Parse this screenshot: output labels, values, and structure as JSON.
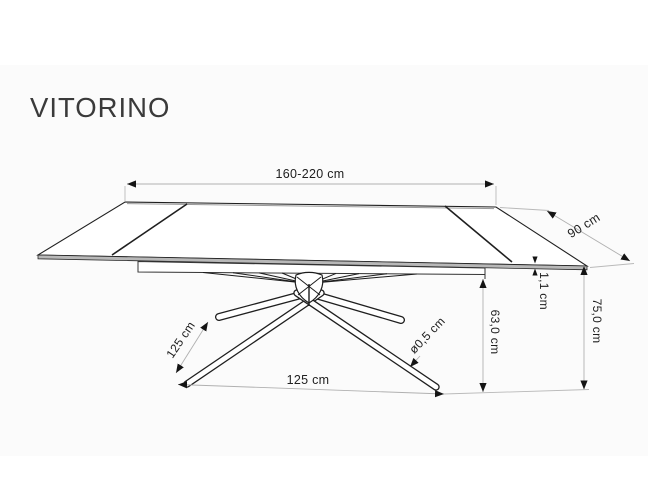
{
  "title": "VITORINO",
  "diagram": {
    "subject": "extendable-dining-table-dimension-drawing",
    "colors": {
      "line": "#1f1f1f",
      "dimension_line": "#b0b0b0",
      "text": "#202020",
      "title": "#3a3a3a",
      "edge_shade": "#b8b8b8",
      "backdrop": "#fbfbfb"
    },
    "labels": {
      "length_range": "160-220 cm",
      "depth": "90 cm",
      "top_thickness": "1,1 cm",
      "total_height": "75,0 cm",
      "clearance_height": "63,0 cm",
      "leg_span_side": "125 cm",
      "leg_span_front": "125 cm",
      "tube_diameter": "ø0,5 cm"
    }
  }
}
